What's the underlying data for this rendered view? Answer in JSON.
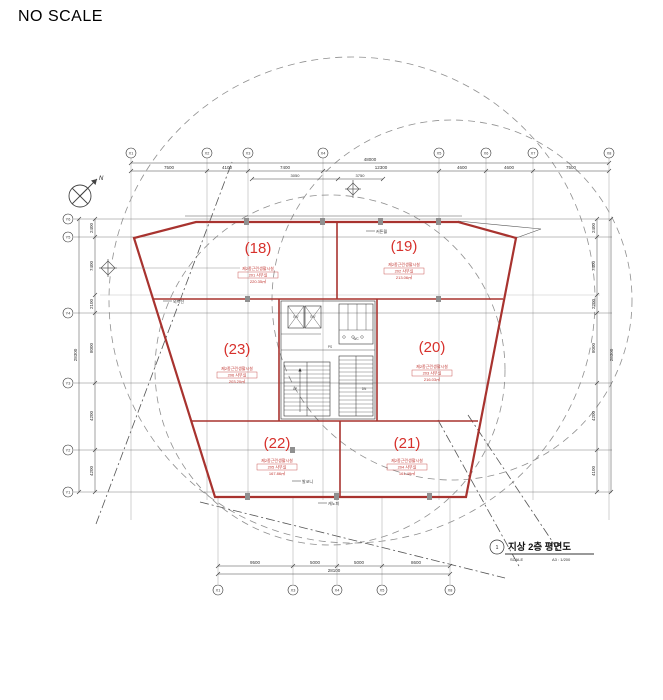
{
  "page": {
    "scale_note": "NO SCALE"
  },
  "drawing": {
    "north_label": "N",
    "rooms": [
      {
        "id": "(18)",
        "type": "제2종근린생활시설",
        "unit": "201 사무실",
        "area": "220.35㎡"
      },
      {
        "id": "(19)",
        "type": "제2종근린생활시설",
        "unit": "202 사무실",
        "area": "213.06㎡"
      },
      {
        "id": "(23)",
        "type": "제2종근린생활시설",
        "unit": "206 사무실",
        "area": "203.20㎡"
      },
      {
        "id": "(20)",
        "type": "제2종근린생활시설",
        "unit": "203 사무실",
        "area": "216.03㎡"
      },
      {
        "id": "(22)",
        "type": "제2종근린생활시설",
        "unit": "205 사무실",
        "area": "167.86㎡"
      },
      {
        "id": "(21)",
        "type": "제2종근린생활시설",
        "unit": "204 사무실",
        "area": "161.49㎡"
      }
    ],
    "core": {
      "ev1": "E/V",
      "ev2": "E/V",
      "wc": "WC",
      "ps": "PS",
      "up": "UP",
      "dn": "DN"
    },
    "grid": {
      "top": [
        "X1",
        "X2",
        "X3",
        "X4",
        "X5",
        "X6",
        "X7",
        "X8"
      ],
      "left": [
        "Y6",
        "Y5",
        "Y4",
        "Y3",
        "Y2",
        "Y1"
      ],
      "bottom": [
        "X1",
        "X3",
        "X4",
        "X5",
        "X8"
      ]
    },
    "dims": {
      "top_total": "48000",
      "top_segs": [
        "7500",
        "4100",
        "7400",
        "12300",
        "4600",
        "4600",
        "7500"
      ],
      "top_sub": [
        "3050",
        "3750"
      ],
      "left_total": "28300",
      "left_segs": [
        "2400",
        "7400",
        "2100",
        "8000",
        "4200",
        "4200"
      ],
      "right_total": "28300",
      "right_segs": [
        "2400",
        "7400",
        "2200",
        "8000",
        "4200",
        "4100"
      ],
      "bottom_total": "28100",
      "bottom_segs": [
        "9500",
        "5000",
        "5000",
        "8600"
      ]
    },
    "annotations": {
      "a1": "외벽선",
      "a2": "커튼월",
      "a3": "발코니",
      "a4": "캐노피"
    },
    "title_block": {
      "no": "1",
      "title": "지상 2층 평면도",
      "scale_label": "SCALE",
      "scale_value": "A3 : 1/200"
    }
  }
}
